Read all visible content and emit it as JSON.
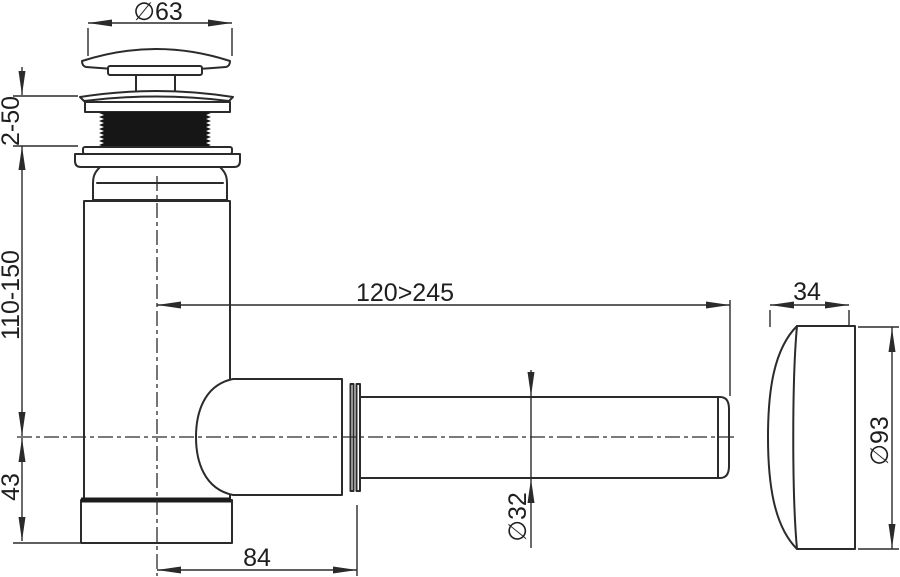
{
  "drawing": {
    "title": "bottle-trap-siphon-technical-drawing",
    "dimensions": {
      "cap_diameter": "∅63",
      "clamp_range": "2-50",
      "body_height_range": "110-150",
      "outlet_axis_to_bottom": "43",
      "horizontal_reach_range": "120>245",
      "body_axis_to_nut_end": "84",
      "flange_depth": "34",
      "flange_diameter": "∅93",
      "pipe_diameter": "∅32"
    },
    "colors": {
      "line": "#2b2b2b",
      "thread_fill": "#161616",
      "background": "#ffffff"
    }
  }
}
